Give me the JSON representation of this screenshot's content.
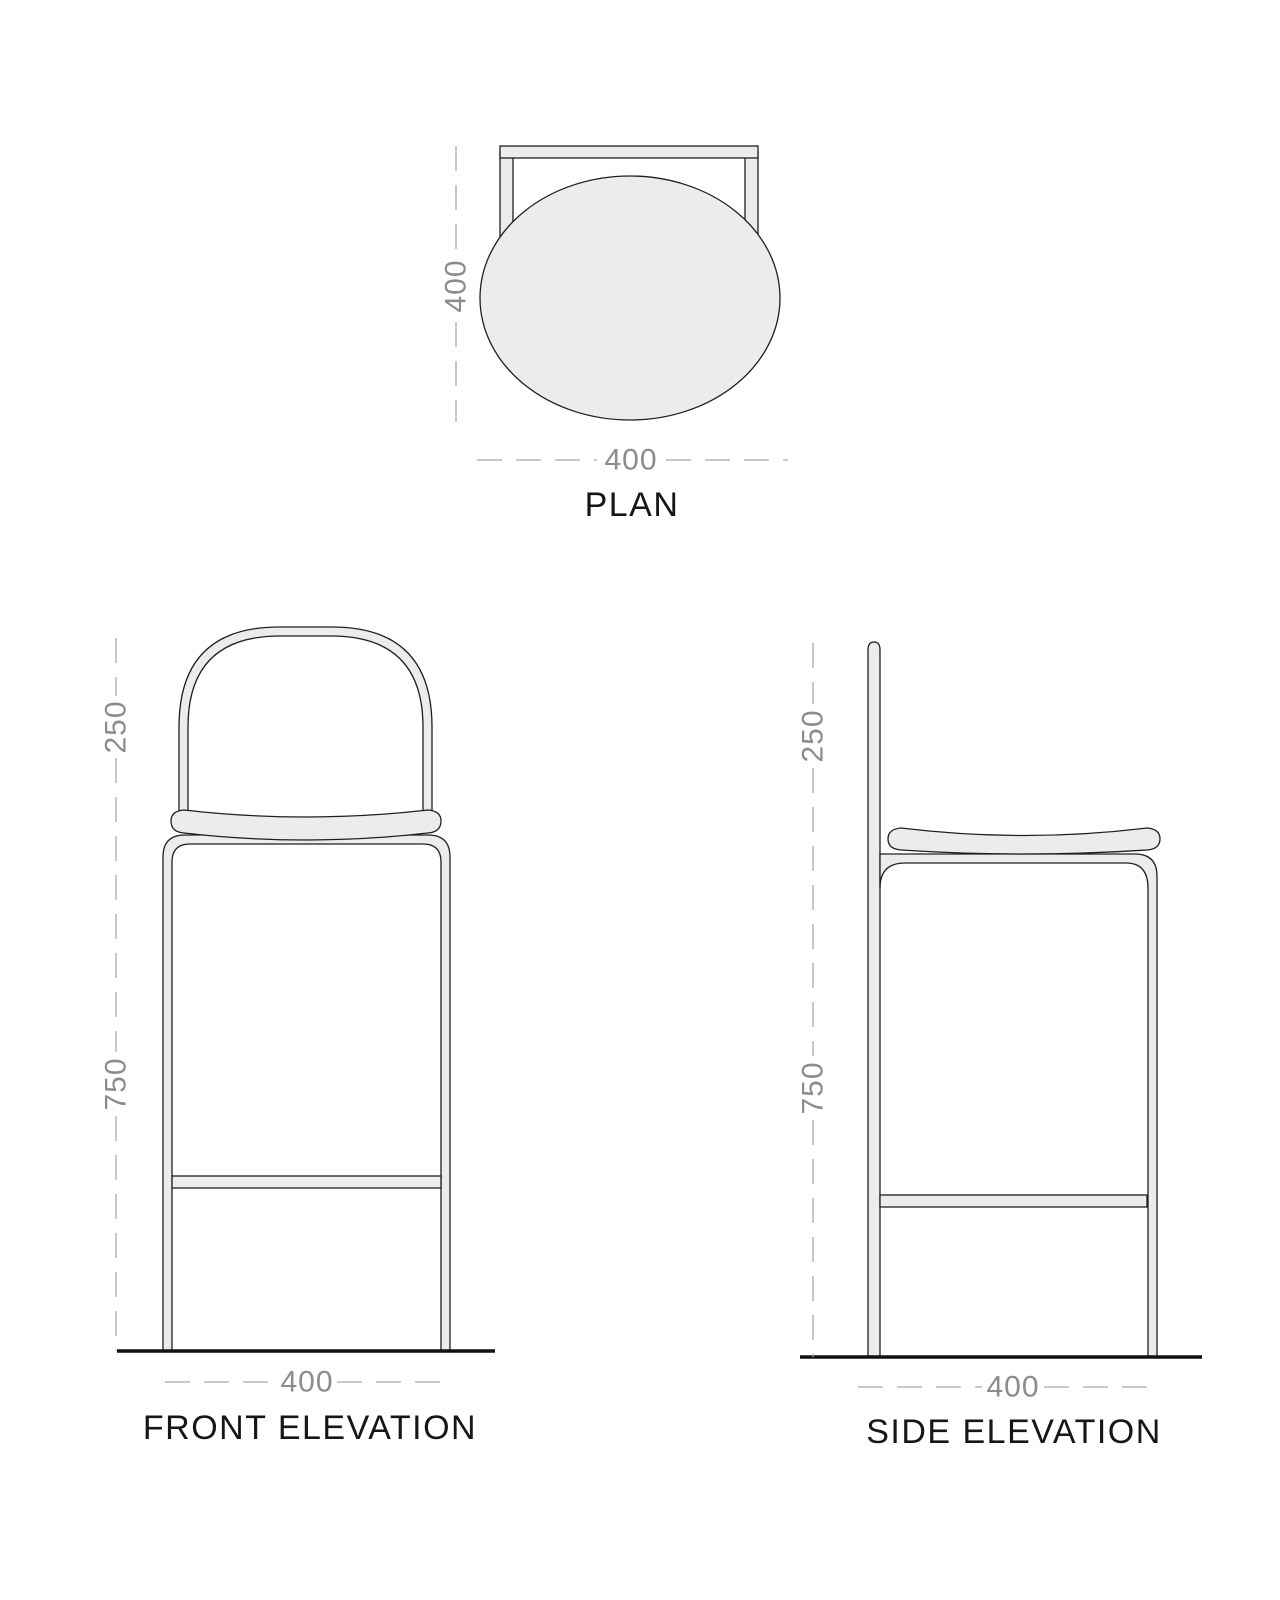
{
  "palette": {
    "background": "#ffffff",
    "line": "#1f1f1f",
    "fill": "#ececec",
    "dim": "#8c8c8c",
    "ground": "#111111"
  },
  "views": {
    "plan": {
      "title": "PLAN",
      "dims": {
        "depth": "400",
        "width": "400"
      }
    },
    "front": {
      "title": "FRONT ELEVATION",
      "dims": {
        "backrest": "250",
        "seat_height": "750",
        "width": "400"
      }
    },
    "side": {
      "title": "SIDE ELEVATION",
      "dims": {
        "backrest": "250",
        "seat_height": "750",
        "depth": "400"
      }
    }
  }
}
